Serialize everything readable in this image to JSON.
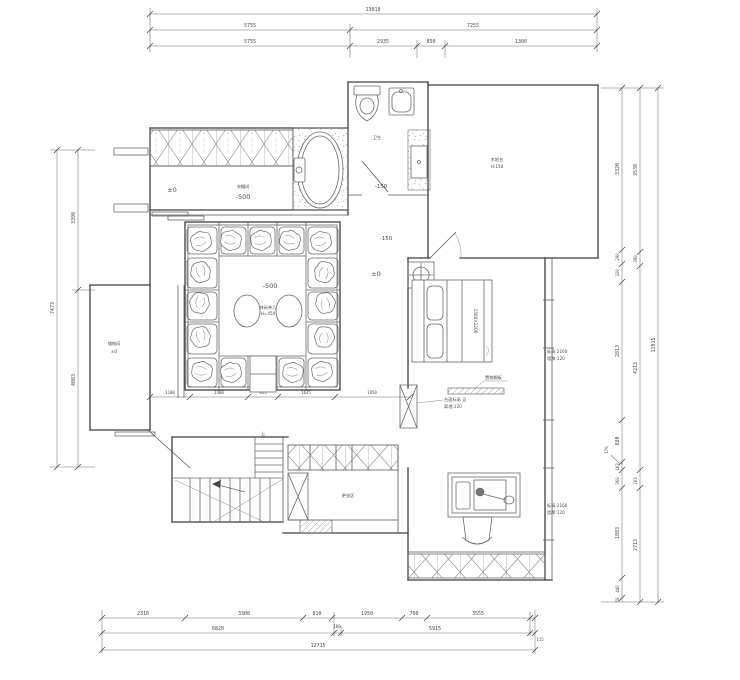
{
  "dims": {
    "top": {
      "total": "13010",
      "seg2": [
        "5755",
        "7255"
      ],
      "seg3": [
        "5755",
        "2935",
        "850",
        "1300"
      ]
    },
    "bottom": {
      "seg1": [
        "2310",
        "3300",
        "810",
        "1950",
        "700",
        "3555"
      ],
      "seg2": [
        "6820",
        "180",
        "5915",
        "115"
      ],
      "total": "12715"
    },
    "left": {
      "seg": [
        "3390",
        "4083"
      ],
      "total": "7473"
    },
    "right": {
      "inner": [
        "3320",
        "290",
        "320",
        "2813",
        "880",
        "163",
        "360",
        "1883",
        "440",
        "50"
      ],
      "mid": [
        "3530",
        "390",
        "4213",
        "163",
        "2713"
      ],
      "leader": "170",
      "total": "11015"
    },
    "interior": [
      "1100",
      "1480",
      "915",
      "1635",
      "1950"
    ]
  },
  "labels": {
    "tl_level": "±0",
    "closet_name": "衣帽间",
    "closet_level": "-500",
    "bath_name": "卫生",
    "bath_level": "-150",
    "hall_level": "-150",
    "entry_level": "±0",
    "pit_level": "-500",
    "pit_note": "休闲茶几",
    "pit_note2": "H=450",
    "tatami_note": "木地台",
    "tatami_note2": "H:150",
    "store_note": "储物间",
    "store_note2": "±0",
    "bed_size": "1500×2200",
    "shelf_label": "置物搁板",
    "shelf_note1": "台面标高 见",
    "shelf_note2": "离地:120",
    "wall_note1": "标高:2160",
    "wall_note2": "墙厚:120",
    "wall_note3": "标高:2160",
    "wall_note4": "墙厚:120",
    "dress_note": "更衣区",
    "stair_up": "上"
  }
}
